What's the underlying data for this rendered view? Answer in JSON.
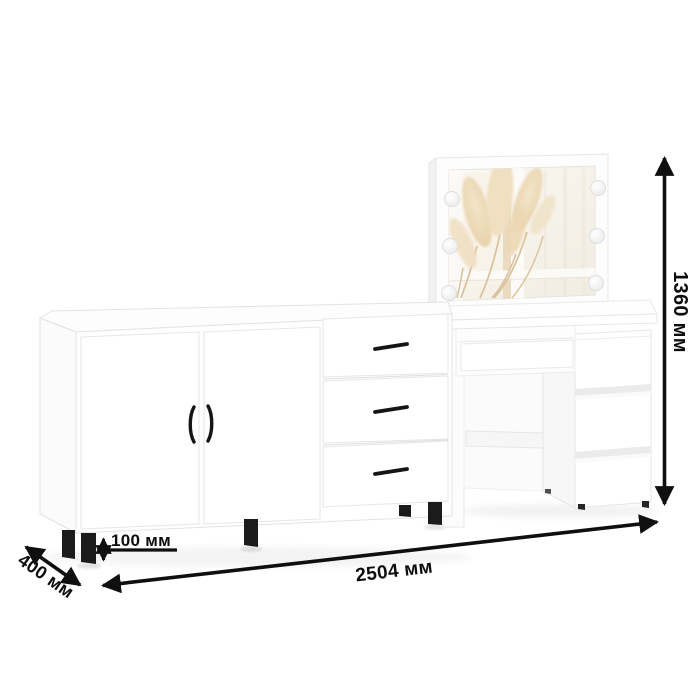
{
  "image": {
    "type": "furniture-dimension-diagram",
    "background": "#ffffff"
  },
  "dimension_labels": {
    "width": "2504 мм",
    "height": "1360 мм",
    "depth": "400 мм",
    "leg_height": "100 мм"
  },
  "furniture": {
    "sideboard": {
      "doors": 2,
      "drawers": 3,
      "legs": 5,
      "body_color": "#ffffff",
      "handle_color": "#151515",
      "leg_color": "#1b1b1b"
    },
    "dressing_table": {
      "wide_drawers": 1,
      "pedestal_drawers": 3,
      "mirror_bulbs": 6,
      "body_color": "#ffffff"
    }
  },
  "colors": {
    "dimension_lines": "#0f0f0f",
    "outline": "#e4e4e4",
    "pampas_grass": "#ecd9b6",
    "mirror_glass": "#f6f2ea"
  }
}
